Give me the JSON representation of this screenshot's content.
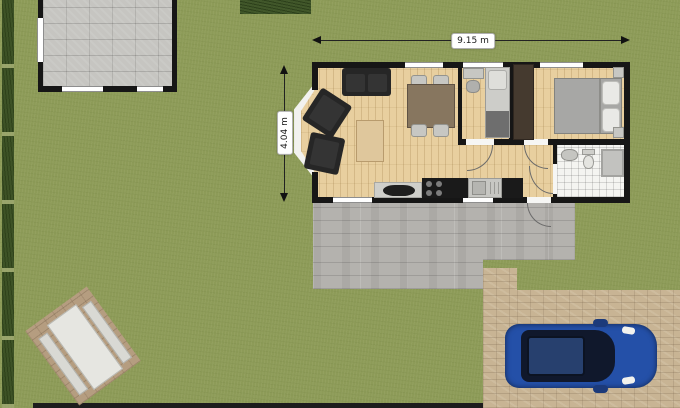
{
  "scene": {
    "type": "residential floor plan with garden, garage, patio, driveway and car"
  },
  "dimension_labels": {
    "width": "9.15 m",
    "depth": "4.04 m"
  },
  "colors": {
    "grass": "#8d9b58",
    "hedge": "#3d5226",
    "wall_black": "#161616",
    "wood_floor": "#e8cf9f",
    "garage_tile": "#c6c5c1",
    "patio_gray": "#b4b2ae",
    "driveway_tan": "#c8b494",
    "bathroom_tile": "#f4f4f1",
    "sofa_dark": "#262626",
    "dining_table": "#87765f",
    "bed_blanket": "#a7a7a5",
    "wardrobe_brown": "#453a2f",
    "car_body_blue": "#2450a8",
    "car_glass": "#10182c"
  }
}
